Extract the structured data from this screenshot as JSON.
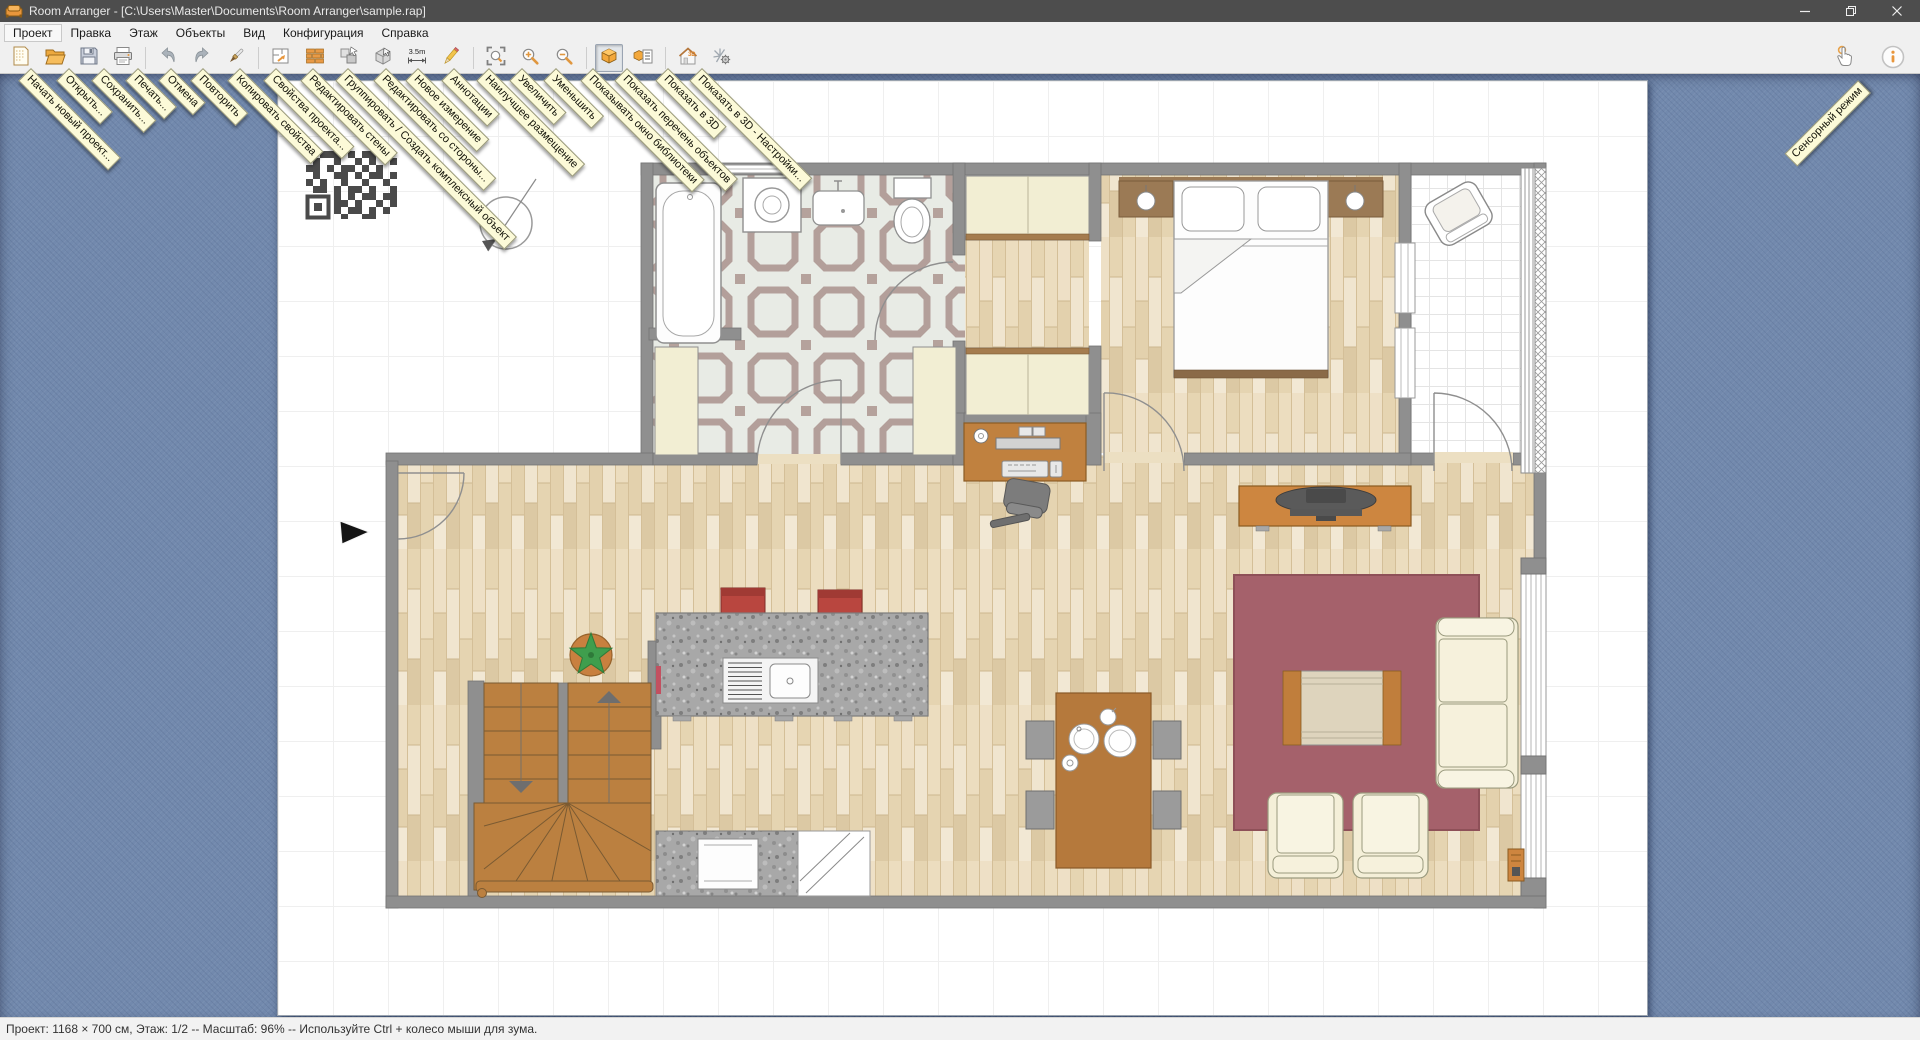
{
  "window": {
    "title": "Room Arranger - [C:\\Users\\Master\\Documents\\Room Arranger\\sample.rap]"
  },
  "menu": {
    "items": [
      "Проект",
      "Правка",
      "Этаж",
      "Объекты",
      "Вид",
      "Конфигурация",
      "Справка"
    ]
  },
  "toolbar": {
    "buttons": [
      {
        "icon": "new-document-icon",
        "tooltip": "Начать новый проект..."
      },
      {
        "icon": "open-folder-icon",
        "tooltip": "Открыть..."
      },
      {
        "icon": "save-floppy-icon",
        "tooltip": "Сохранить..."
      },
      {
        "icon": "print-icon",
        "tooltip": "Печать..."
      },
      {
        "icon": "undo-icon",
        "tooltip": "Отмена"
      },
      {
        "icon": "redo-icon",
        "tooltip": "Повторить"
      },
      {
        "icon": "brush-icon",
        "tooltip": "Копировать свойства"
      },
      {
        "icon": "floor-plan-icon",
        "tooltip": "Свойства проекта..."
      },
      {
        "icon": "brick-wall-icon",
        "tooltip": "Редактировать стены"
      },
      {
        "icon": "group-objects-icon",
        "tooltip": "Группировать / Создать комплексный объект"
      },
      {
        "icon": "cube-cursor-icon",
        "tooltip": "Редактировать со стороны..."
      },
      {
        "icon": "measure-icon",
        "icon_text": "3.5m",
        "tooltip": "Новое измерение"
      },
      {
        "icon": "pencil-icon",
        "tooltip": "Аннотации"
      },
      {
        "icon": "fit-view-icon",
        "tooltip": "Наилучшее размещение"
      },
      {
        "icon": "zoom-in-icon",
        "tooltip": "Увеличить"
      },
      {
        "icon": "zoom-out-icon",
        "tooltip": "Уменьшить"
      },
      {
        "icon": "library-cube-icon",
        "tooltip": "Показывать окно библиотеки",
        "pressed": true
      },
      {
        "icon": "object-list-icon",
        "tooltip": "Показать перечень объектов"
      },
      {
        "icon": "house-3d-icon",
        "icon_text": "3D",
        "tooltip": "Показать в 3D"
      },
      {
        "icon": "3d-settings-icon",
        "tooltip": "Показать в 3D - Настройки..."
      }
    ],
    "touch_mode_tooltip": "Сенсорный режим"
  },
  "status_bar": {
    "text": "Проект: 1168 × 700 см, Этаж: 1/2 -- Масштаб: 96% -- Используйте Ctrl + колесо мыши для зума.",
    "project_size": "1168 × 700 см",
    "floor": "1/2",
    "scale": "96%"
  },
  "colors": {
    "desktop_blue": "#7289ad",
    "wall_gray": "#8f8f8f",
    "wood_floor": "#eadfc6",
    "accent_orange": "#f0a43c",
    "rug_red": "#a5616b",
    "stool_red": "#b9463f",
    "tooltip_bg": "#fcfad8"
  }
}
